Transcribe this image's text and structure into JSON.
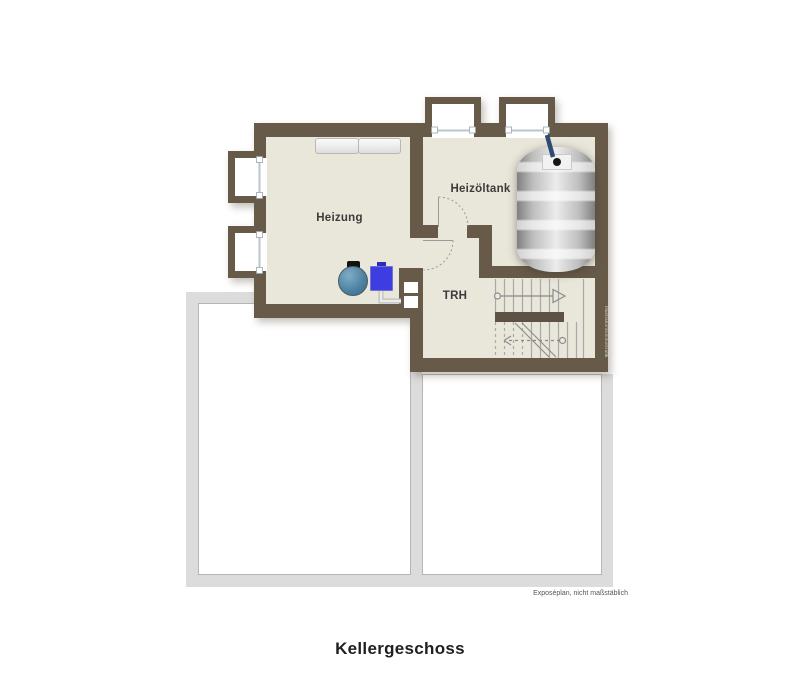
{
  "floor_title": "Kellergeschoss",
  "footnote": "Exposéplan, nicht maßstäblich",
  "watermark": "Illustration©immoGrafik",
  "rooms": {
    "heizung": {
      "label": "Heizung"
    },
    "heizoeltank": {
      "label": "Heizöltank"
    },
    "trh": {
      "label": "TRH"
    }
  },
  "fixtures": {
    "oil_tank": "oil-tank",
    "boiler": "boiler",
    "pump": "pump",
    "chimney": "chimney-with-two-flues",
    "stairs": "staircase-with-landing",
    "windows": "four-basement-light-well-windows",
    "doors": "two-door-swing-arcs"
  },
  "colors": {
    "wall": "#675a49",
    "floor": "#e9e6da",
    "outline_band": "#dcdcdc",
    "outline_line": "#b5b5b5",
    "boiler": "#4f83a5",
    "pump": "#3d3de2",
    "stair_line": "#a9a9a9",
    "text": "#3b3b3b"
  }
}
